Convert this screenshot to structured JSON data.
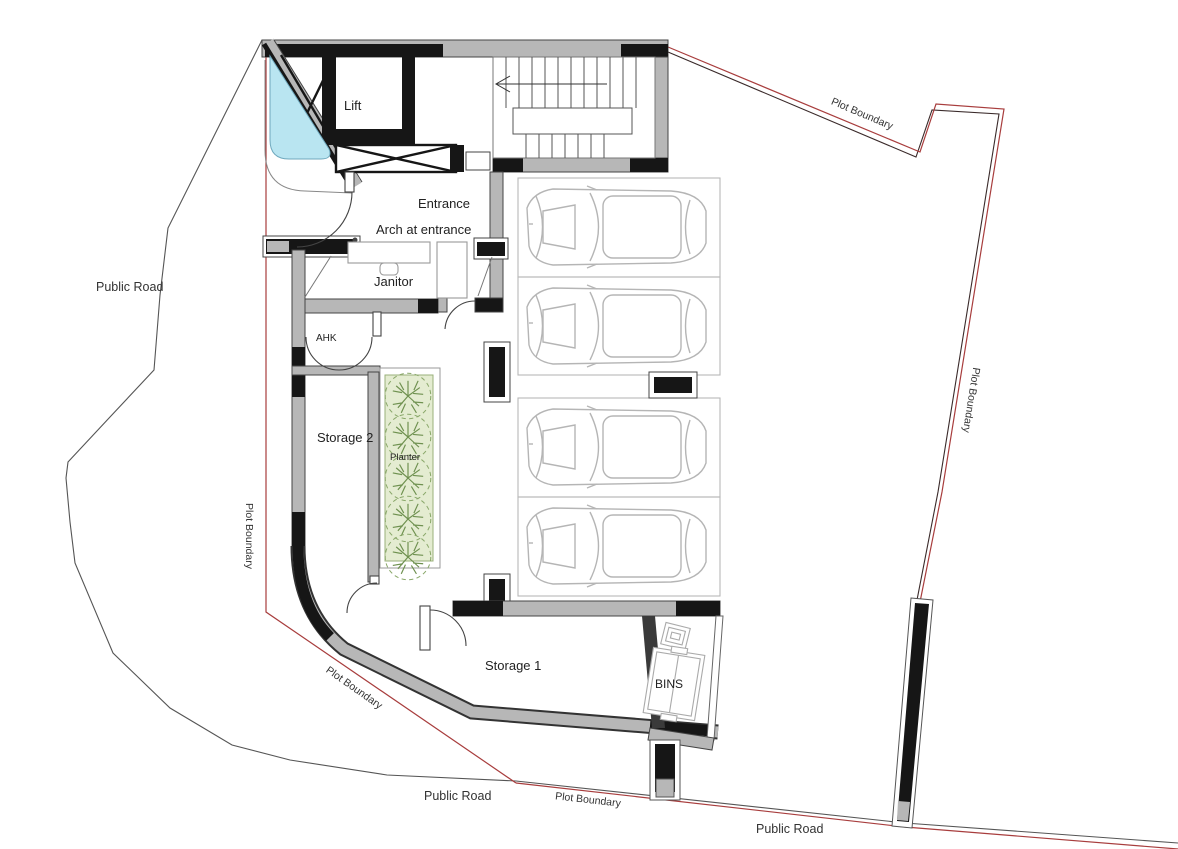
{
  "drawing": {
    "type": "architectural-site-plan",
    "rooms": {
      "lift": "Lift",
      "entrance": "Entrance",
      "arch_at_entrance": "Arch at entrance",
      "janitor": "Janitor",
      "ahk": "AHK",
      "storage_2": "Storage 2",
      "planter": "Planter",
      "storage_1": "Storage 1",
      "bins": "BINS"
    },
    "site_labels": {
      "public_road_left": "Public Road",
      "public_road_bottom": "Public Road",
      "public_road_bottom_right": "Public Road",
      "plot_boundary_top_right": "Plot Boundary",
      "plot_boundary_right": "Plot Boundary",
      "plot_boundary_left": "Plot Boundary",
      "plot_boundary_bottom_left": "Plot Boundary",
      "plot_boundary_bottom": "Plot Boundary"
    },
    "colors": {
      "wall_black": "#161616",
      "wall_gray": "#b7b7b7",
      "boundary_red": "#a83d3d",
      "road_line": "#555555",
      "water_feature_fill": "#b9e5f1",
      "planter_fill": "#e4ecd1",
      "plant_green": "#6f9150",
      "car_outline": "#b5b5b5",
      "text": "#222222"
    },
    "parking_stall_count": 4
  }
}
